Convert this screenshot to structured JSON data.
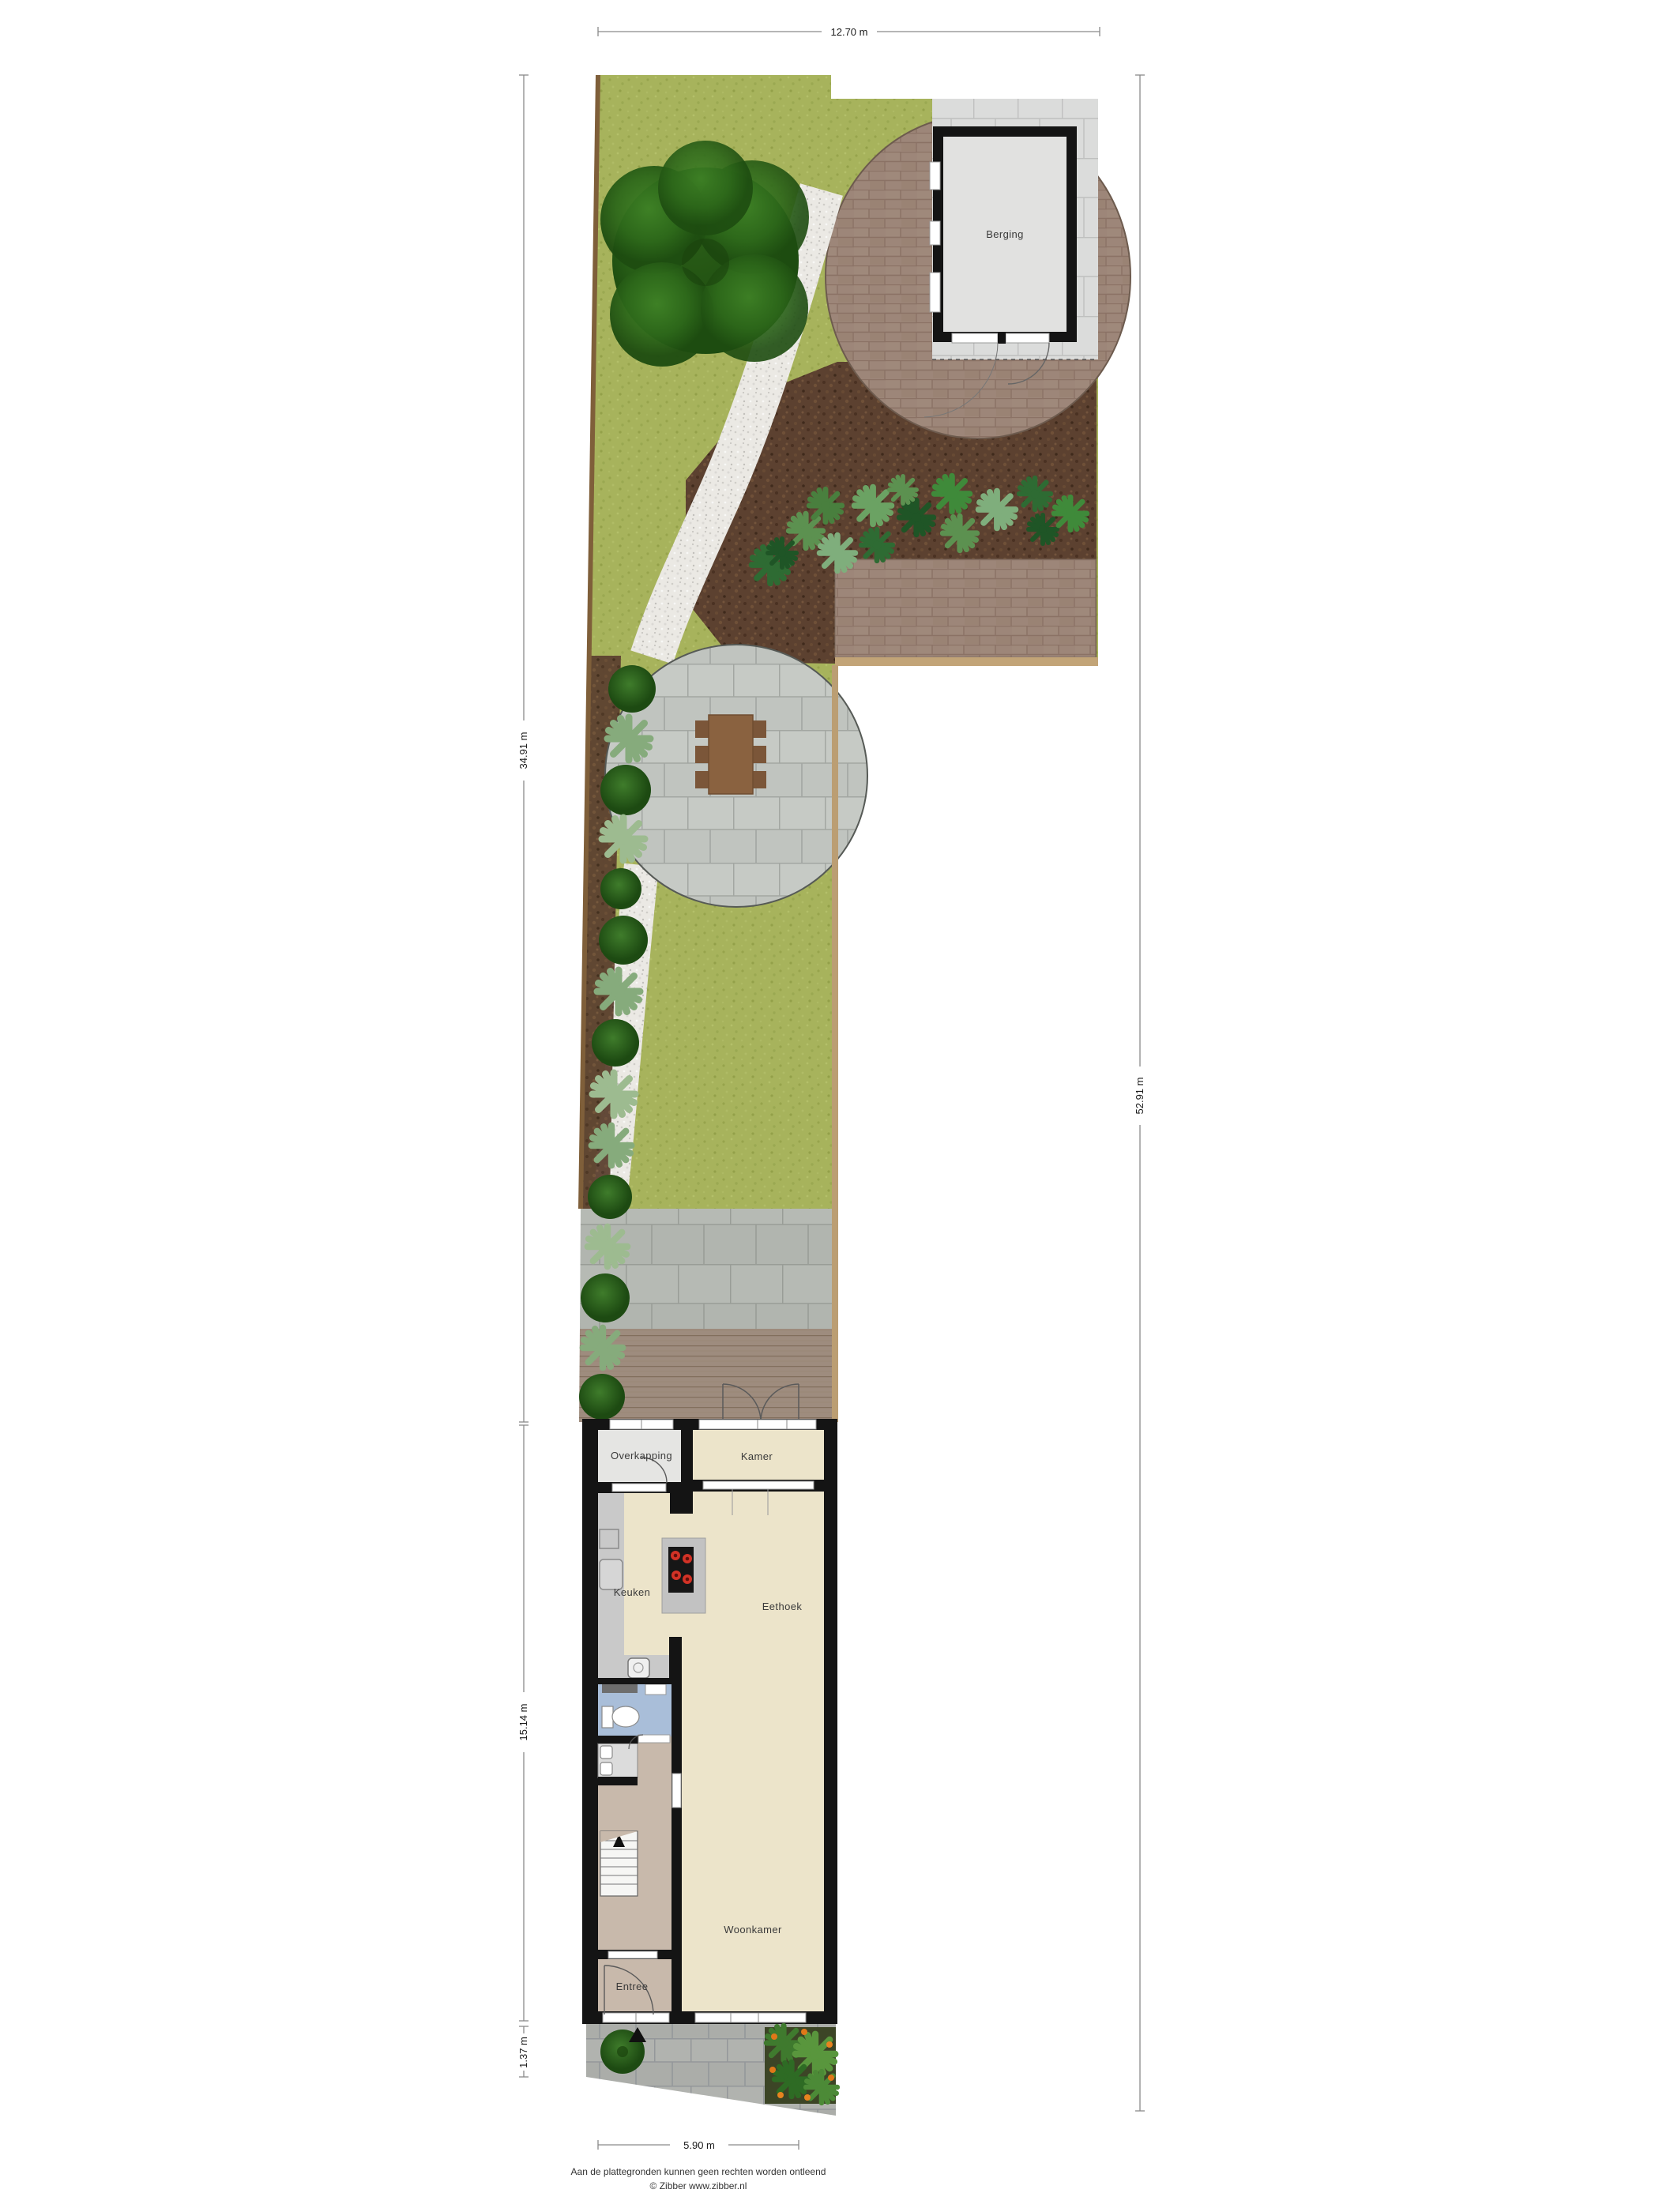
{
  "plan": {
    "dimensions": {
      "top": "12.70 m",
      "right": "52.91 m",
      "garden_left": "34.91 m",
      "house_left": "15.14 m",
      "front_left": "1.37 m",
      "bottom": "5.90 m"
    },
    "rooms": {
      "berging": "Berging",
      "overkapping": "Overkapping",
      "kamer": "Kamer",
      "keuken": "Keuken",
      "eethoek": "Eethoek",
      "woonkamer": "Woonkamer",
      "entree": "Entree"
    },
    "footer": {
      "disclaimer": "Aan de plattegronden kunnen geen rechten worden ontleend",
      "copyright": "© Zibber www.zibber.nl"
    },
    "colors": {
      "lawn": "#a7b35c",
      "mulch": "#5c4130",
      "patio_brick": "#9d8679",
      "gravel": "#ebe9e4",
      "paver_gray": "#c4c8c3",
      "floor_beige": "#ece4ca",
      "floor_hall": "#c8b9ab",
      "toilet_blue": "#a9bed9",
      "wall": "#141414"
    }
  }
}
